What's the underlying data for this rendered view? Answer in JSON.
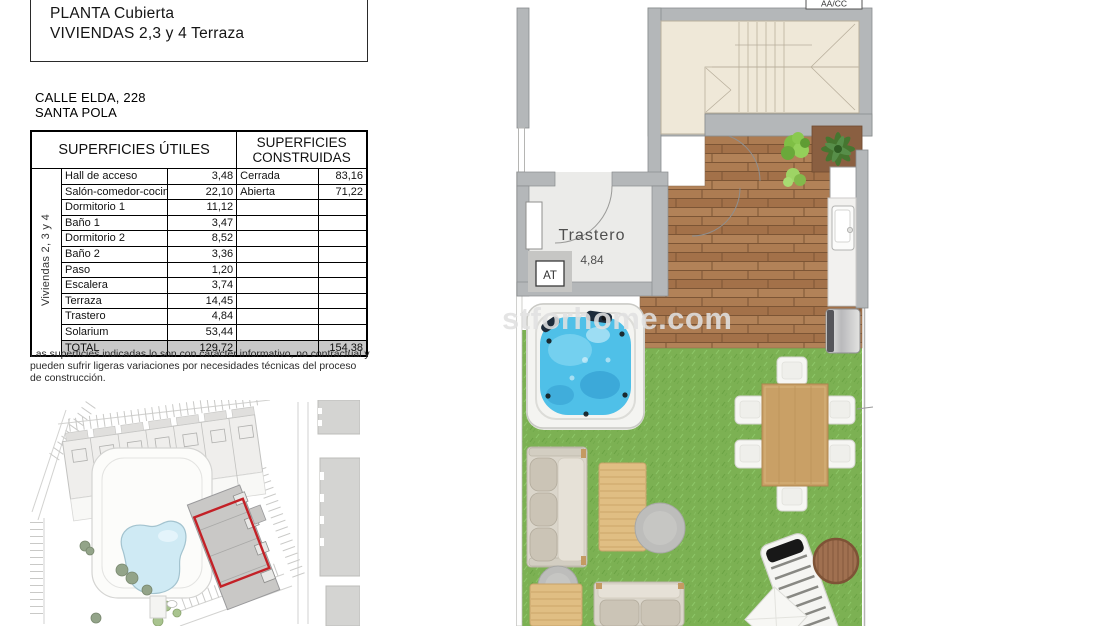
{
  "title_block": {
    "line1": "PLANTA Cubierta",
    "line2": "VIVIENDAS 2,3 y 4 Terraza"
  },
  "address": {
    "line1": "CALLE ELDA, 228",
    "line2": "SANTA POLA"
  },
  "surfaces_table": {
    "header_left": "SUPERFICIES ÚTILES",
    "header_right": "SUPERFICIES CONSTRUIDAS",
    "side_label": "Viviendas 2, 3 y 4",
    "rows": [
      {
        "name": "Hall de acceso",
        "value": "3,48",
        "name2": "Cerrada",
        "value2": "83,16"
      },
      {
        "name": "Salón-comedor-cocina",
        "value": "22,10",
        "name2": "Abierta",
        "value2": "71,22"
      },
      {
        "name": "Dormitorio 1",
        "value": "11,12",
        "name2": "",
        "value2": ""
      },
      {
        "name": "Baño 1",
        "value": "3,47",
        "name2": "",
        "value2": ""
      },
      {
        "name": "Dormitorio 2",
        "value": "8,52",
        "name2": "",
        "value2": ""
      },
      {
        "name": "Baño 2",
        "value": "3,36",
        "name2": "",
        "value2": ""
      },
      {
        "name": "Paso",
        "value": "1,20",
        "name2": "",
        "value2": ""
      },
      {
        "name": "Escalera",
        "value": "3,74",
        "name2": "",
        "value2": ""
      },
      {
        "name": "Terraza",
        "value": "14,45",
        "name2": "",
        "value2": ""
      },
      {
        "name": "Trastero",
        "value": "4,84",
        "name2": "",
        "value2": ""
      },
      {
        "name": "Solarium",
        "value": "53,44",
        "name2": "",
        "value2": ""
      }
    ],
    "total": {
      "name": "TOTAL",
      "value": "129,72",
      "name2": "",
      "value2": "154,38"
    }
  },
  "disclaimer": "Las superficies indicadas lo son con carácter informativo, no contractual y pueden sufrir ligeras variaciones por necesidades técnicas del proceso de construcción.",
  "floor_plan": {
    "room_label": "Trastero",
    "room_area": "4,84",
    "at_label": "AT",
    "aacc_label": "AA/CC",
    "watermark": "stforhome.com"
  },
  "colors": {
    "wall_gray": "#b4b7b9",
    "roof_beige": "#efe8d8",
    "deck_brown": "#aa7a50",
    "grass_green": "#7cb153",
    "water_blue": "#4fc0e8",
    "pool_blue": "#cfeaf4",
    "highlight_red": "#c32127",
    "total_row_gray": "#c8c8c8"
  }
}
